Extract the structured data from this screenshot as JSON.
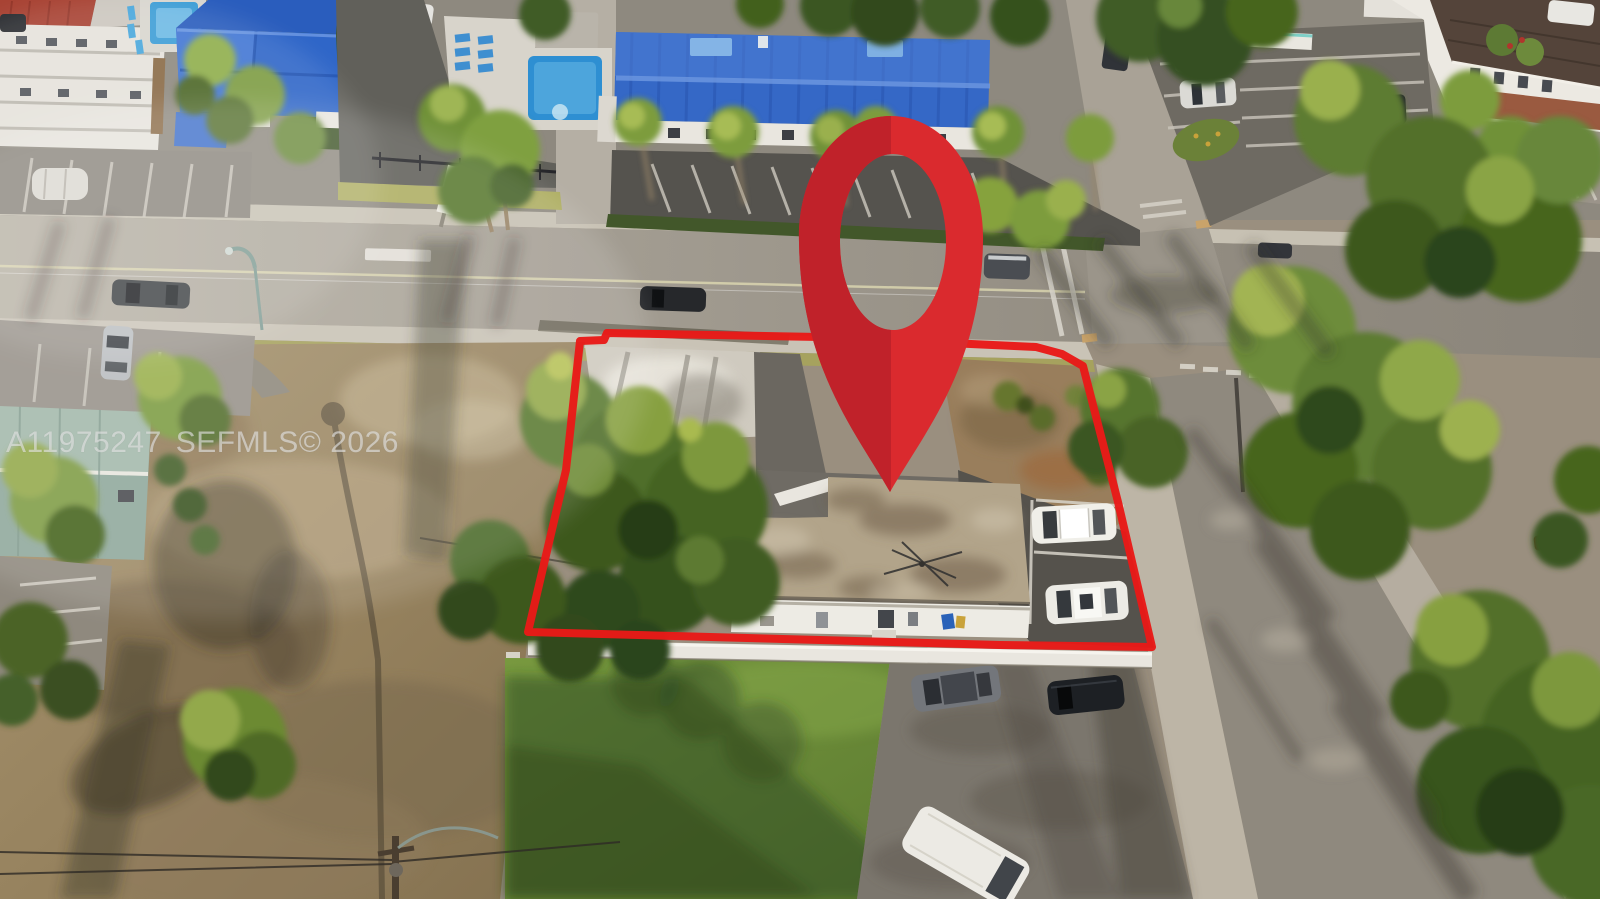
{
  "watermark": {
    "listing_id": "A11975247",
    "mls_notice": "SEFMLS© 2026"
  },
  "overlay": {
    "map_pin": {
      "icon": "map-pin-icon",
      "color_left": "#c0222a",
      "color_right": "#da2a2e"
    },
    "property_boundary": {
      "icon": "property-boundary-outline",
      "color": "#e81a18"
    }
  }
}
